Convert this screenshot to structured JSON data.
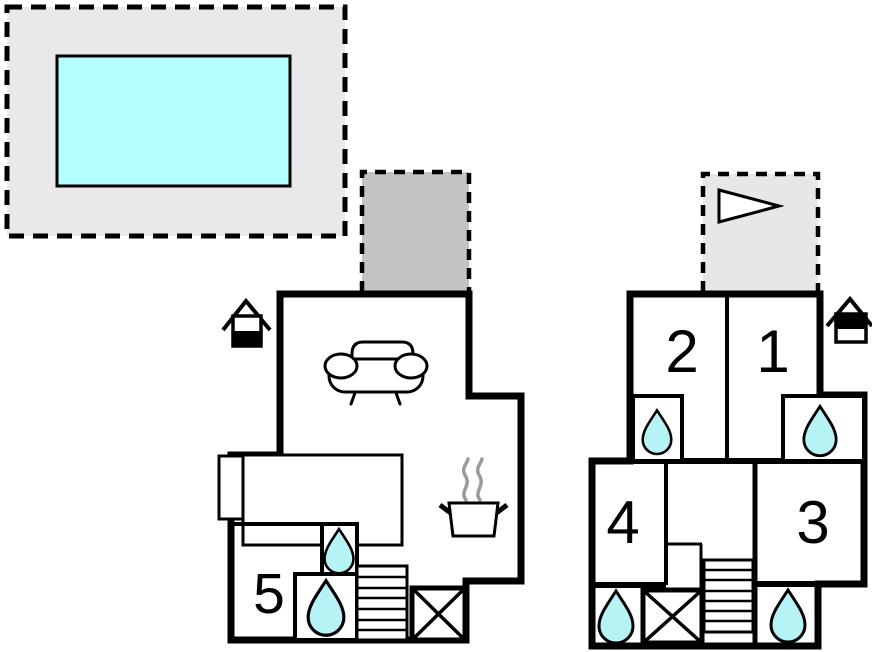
{
  "colors": {
    "pool_water": "#b3ffff",
    "water_drop": "#b6f3f5",
    "pool_surround": "#e9e9e9",
    "terrace": "#c3c3c3",
    "balcony": "#e7e7e7",
    "wall": "#000000",
    "steam": "#9b9b9b"
  },
  "plans": {
    "ground_floor": {
      "rooms": [
        {
          "number": "5"
        }
      ]
    },
    "first_floor": {
      "rooms": [
        {
          "number": "2"
        },
        {
          "number": "1"
        },
        {
          "number": "4"
        },
        {
          "number": "3"
        }
      ]
    }
  },
  "icons": {
    "pool": "swimming-pool-icon",
    "terrace": "terrace-area-icon",
    "balcony": "balcony-area-icon",
    "flag": "direction-flag-icon",
    "sofa": "sofa-icon",
    "stove": "cooking-pot-icon",
    "water": "water-drop-icon",
    "stairs": "stairs-icon",
    "shaft": "void-cross-icon",
    "ground_floor_marker": "house-ground-floor-icon",
    "first_floor_marker": "house-upper-floor-icon"
  }
}
